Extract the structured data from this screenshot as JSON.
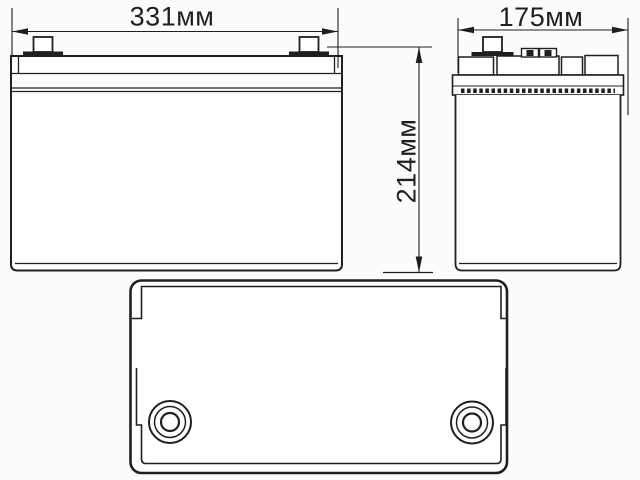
{
  "colors": {
    "background": "#fcfcfc",
    "line": "#1f1f1f",
    "fill": "#ffffff"
  },
  "dimensions": {
    "width_label": "331мм",
    "depth_label": "175мм",
    "height_label": "214мм"
  }
}
